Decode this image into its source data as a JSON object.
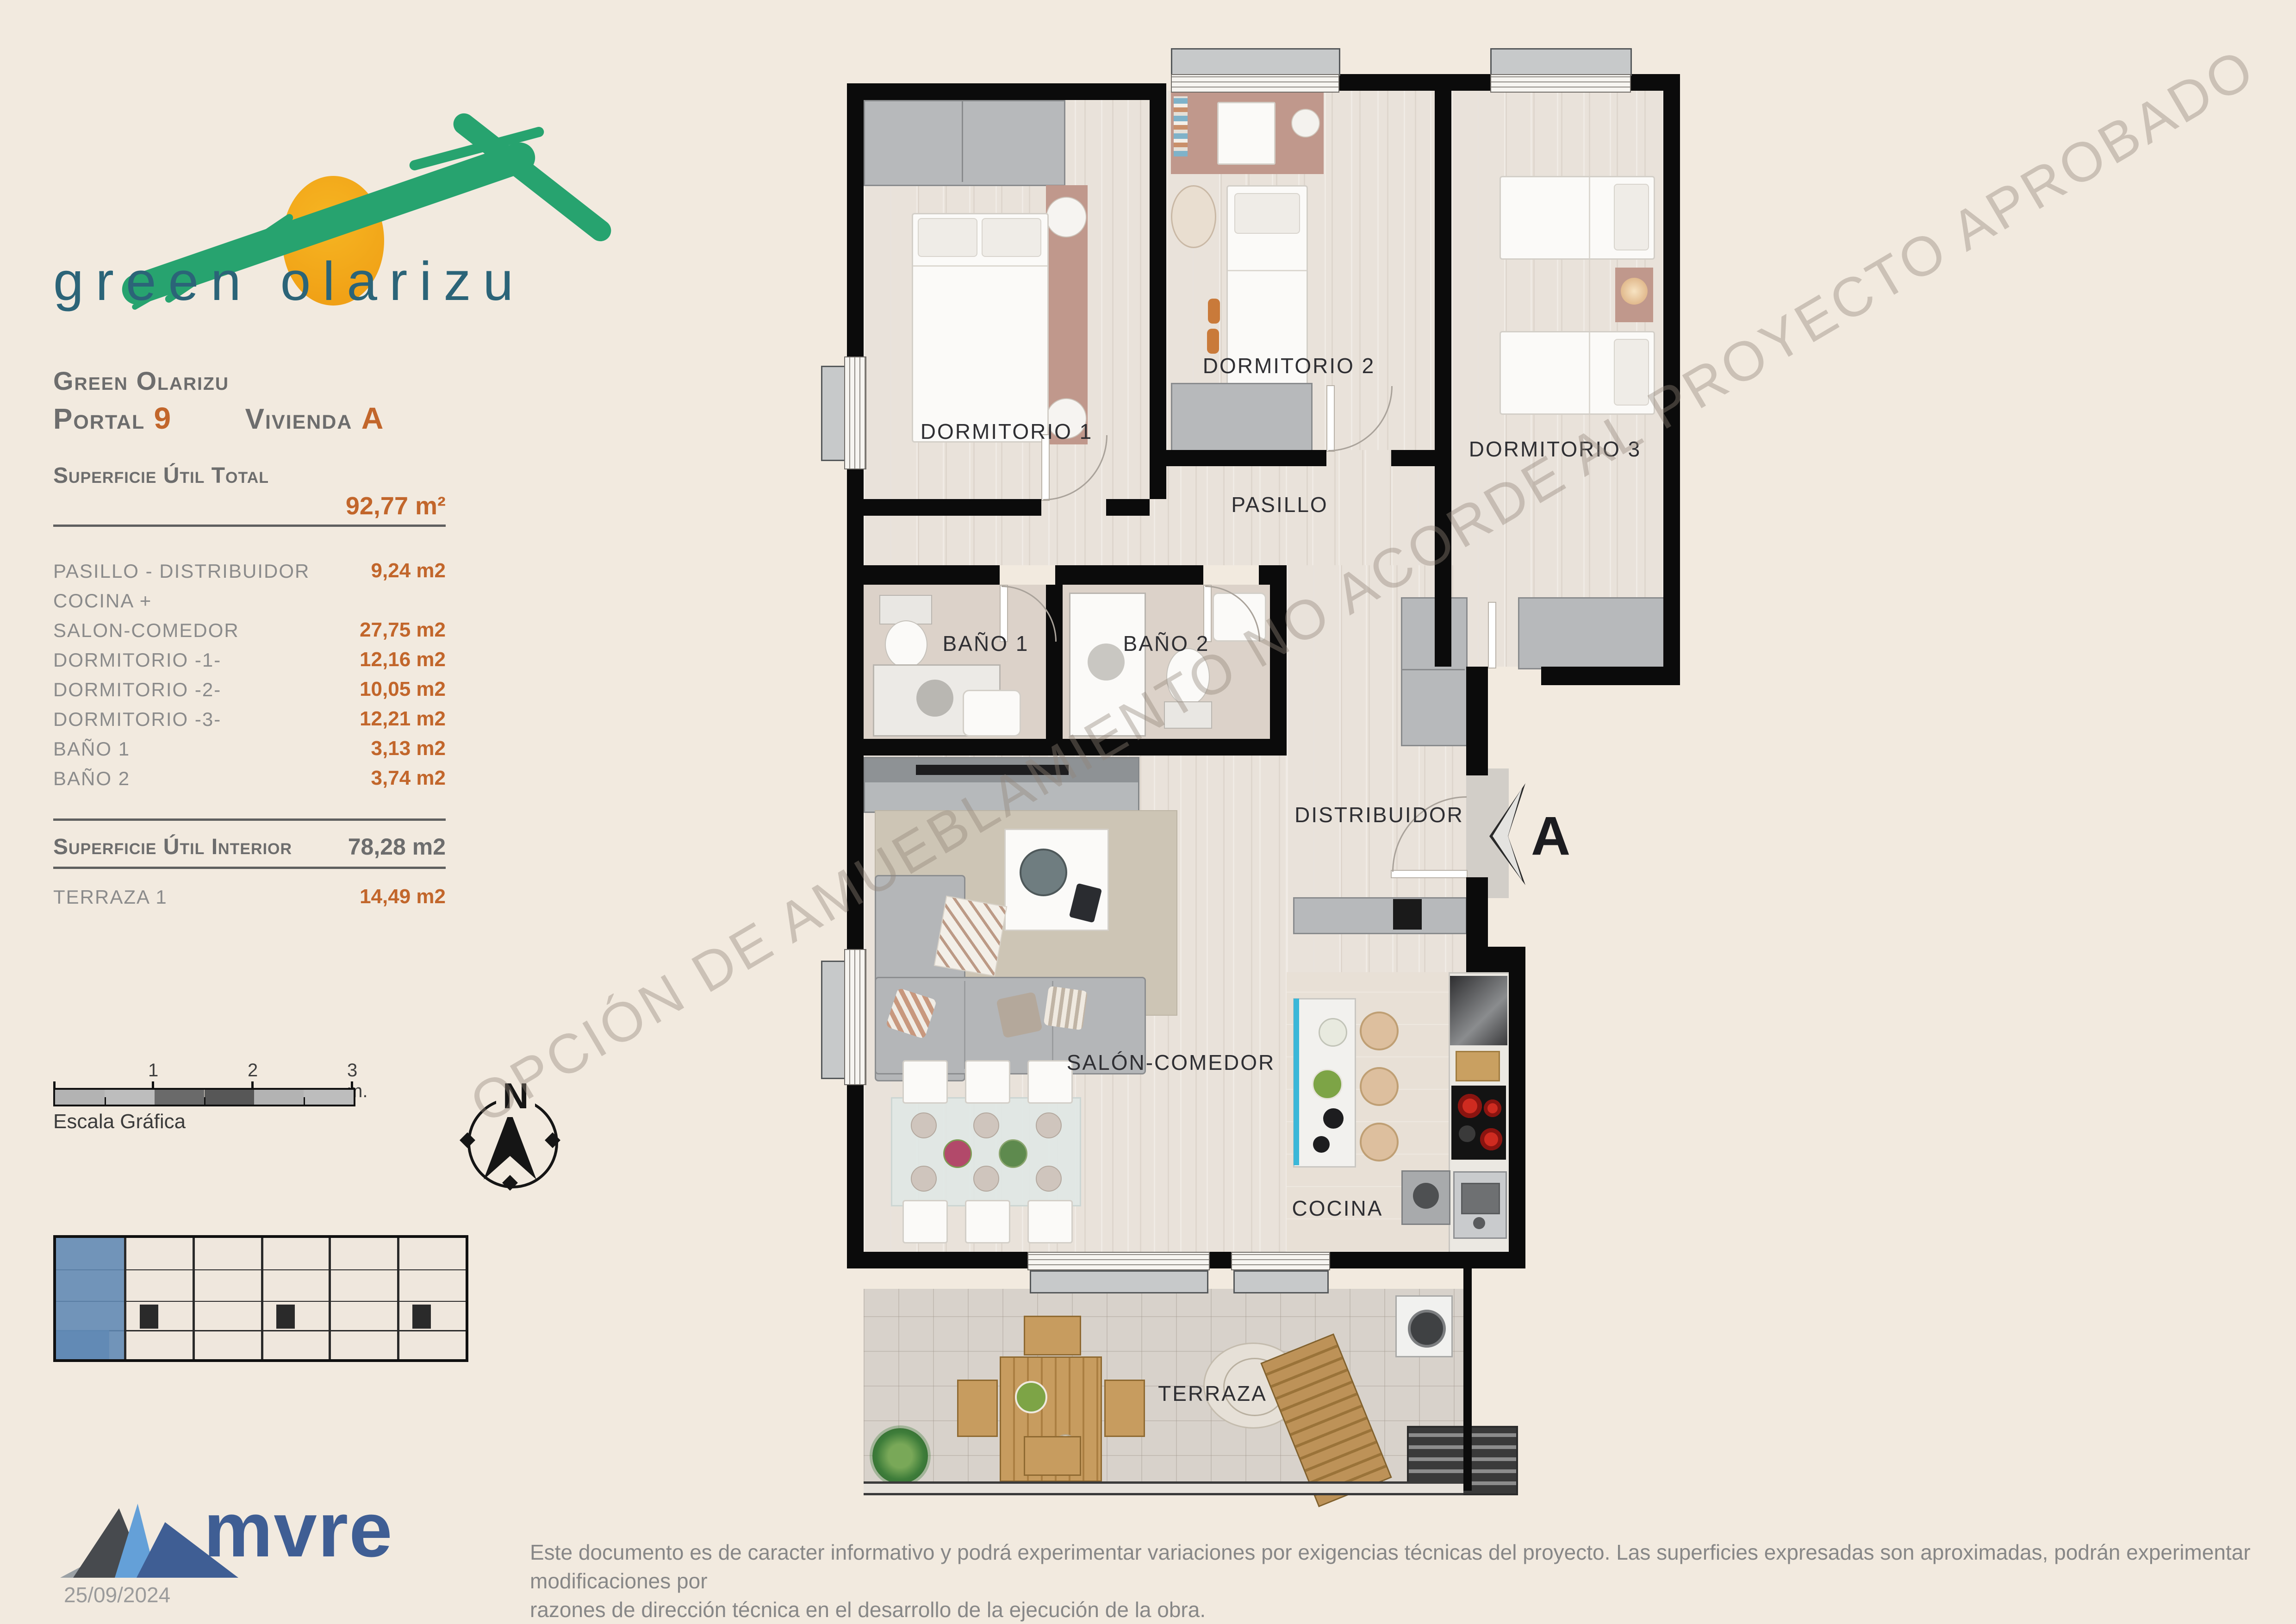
{
  "logo": {
    "wordmark": "green olarizu"
  },
  "header": {
    "project": "Green Olarizu",
    "portal_label": "Portal",
    "portal_number": "9",
    "vivienda_label": "Vivienda",
    "vivienda_letter": "A"
  },
  "surface": {
    "total_label": "Superficie Útil Total",
    "total_value": "92,77 m²",
    "rows": [
      {
        "label": "PASILLO - DISTRIBUIDOR",
        "value": "9,24 m2"
      },
      {
        "label": "COCINA +",
        "value": ""
      },
      {
        "label": "SALON-COMEDOR",
        "value": "27,75 m2"
      },
      {
        "label": "DORMITORIO -1-",
        "value": "12,16 m2"
      },
      {
        "label": "DORMITORIO -2-",
        "value": "10,05 m2"
      },
      {
        "label": "DORMITORIO -3-",
        "value": "12,21 m2"
      },
      {
        "label": "BAÑO 1",
        "value": "3,13 m2"
      },
      {
        "label": "BAÑO 2",
        "value": "3,74 m2"
      }
    ],
    "interior_label": "Superficie Útil Interior",
    "interior_value": "78,28 m2",
    "terraza_label": "TERRAZA 1",
    "terraza_value": "14,49 m2"
  },
  "scalebar": {
    "tick1": "1",
    "tick2": "2",
    "tick3": "3 m.",
    "caption": "Escala Gráfica"
  },
  "compass": {
    "north_label": "N"
  },
  "plan": {
    "section_marker": "A",
    "rooms": [
      {
        "label": "DORMITORIO 1"
      },
      {
        "label": "DORMITORIO 2"
      },
      {
        "label": "DORMITORIO 3"
      },
      {
        "label": "PASILLO"
      },
      {
        "label": "BAÑO 1"
      },
      {
        "label": "BAÑO 2"
      },
      {
        "label": "DISTRIBUIDOR"
      },
      {
        "label": "SALÓN-COMEDOR"
      },
      {
        "label": "COCINA"
      },
      {
        "label": "TERRAZA"
      }
    ]
  },
  "watermark": {
    "text": "OPCIÓN DE AMUEBLAMIENTO NO ACORDE AL PROYECTO APROBADO"
  },
  "footer": {
    "brand": "mvre",
    "date": "25/09/2024",
    "disclaimer_line1": "Este documento es de caracter informativo y podrá experimentar variaciones por exigencias técnicas del proyecto. Las superficies expresadas son aproximadas, podrán experimentar modificaciones por",
    "disclaimer_line2": "razones de dirección técnica en el desarrollo de la ejecución de la obra."
  }
}
